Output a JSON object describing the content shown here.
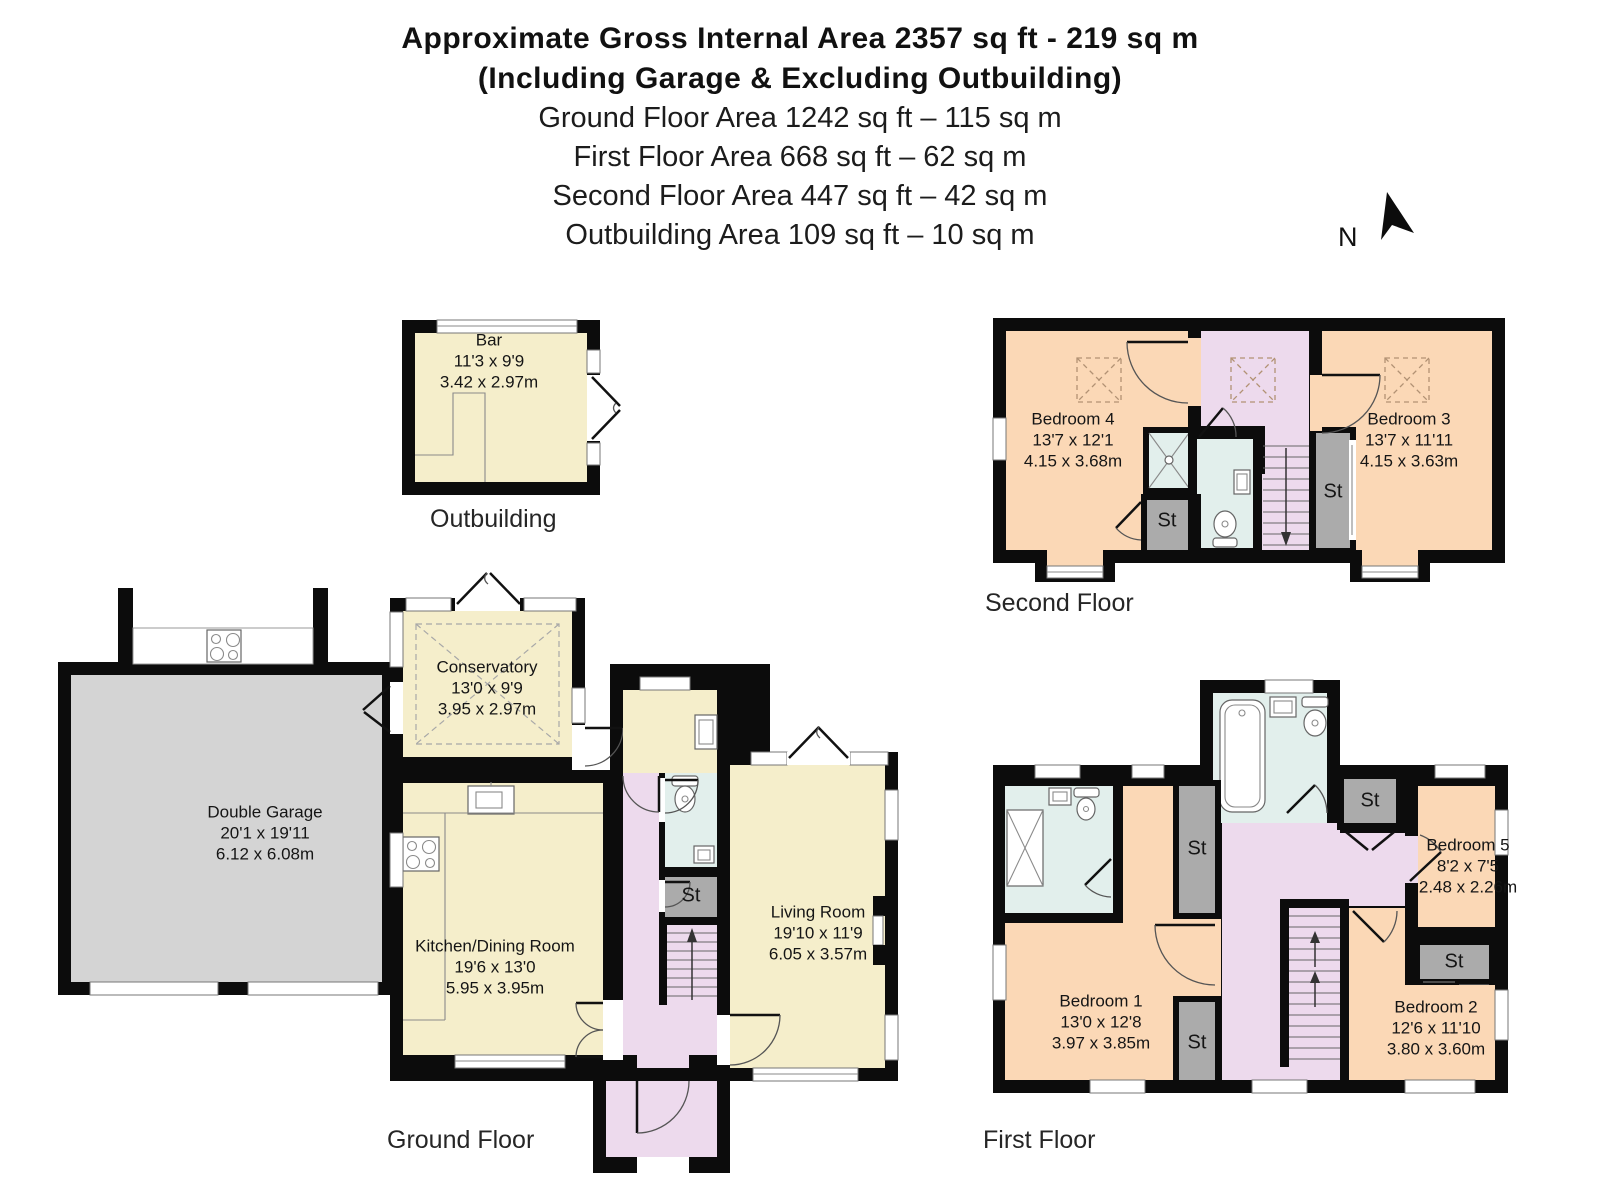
{
  "header": {
    "title_bold_1": "Approximate Gross Internal Area 2357 sq ft - 219 sq m",
    "title_bold_2": "(Including Garage & Excluding Outbuilding)",
    "area_lines": [
      "Ground Floor Area 1242 sq ft – 115 sq m",
      "First Floor Area 668 sq ft – 62 sq m",
      "Second Floor Area 447 sq ft – 42 sq m",
      "Outbuilding Area 109 sq ft – 10 sq m"
    ]
  },
  "compass": {
    "north_label": "N"
  },
  "labels": {
    "st": "St"
  },
  "floor_labels": {
    "outbuilding": "Outbuilding",
    "ground": "Ground Floor",
    "first": "First Floor",
    "second": "Second Floor"
  },
  "rooms": {
    "bar": {
      "name": "Bar",
      "imperial": "11'3 x 9'9",
      "metric": "3.42 x 2.97m"
    },
    "garage": {
      "name": "Double Garage",
      "imperial": "20'1 x 19'11",
      "metric": "6.12 x 6.08m"
    },
    "conservatory": {
      "name": "Conservatory",
      "imperial": "13'0 x 9'9",
      "metric": "3.95 x 2.97m"
    },
    "kitchen": {
      "name": "Kitchen/Dining Room",
      "imperial": "19'6 x 13'0",
      "metric": "5.95 x 3.95m"
    },
    "living": {
      "name": "Living Room",
      "imperial": "19'10 x 11'9",
      "metric": "6.05 x 3.57m"
    },
    "bedroom1": {
      "name": "Bedroom 1",
      "imperial": "13'0 x 12'8",
      "metric": "3.97 x 3.85m"
    },
    "bedroom2": {
      "name": "Bedroom 2",
      "imperial": "12'6 x 11'10",
      "metric": "3.80 x 3.60m"
    },
    "bedroom5": {
      "name": "Bedroom 5",
      "imperial": "8'2 x 7'5",
      "metric": "2.48 x 2.26m"
    },
    "bedroom3": {
      "name": "Bedroom 3",
      "imperial": "13'7 x 11'11",
      "metric": "4.15 x 3.63m"
    },
    "bedroom4": {
      "name": "Bedroom 4",
      "imperial": "13'7 x 12'1",
      "metric": "4.15 x 3.68m"
    }
  },
  "colors": {
    "wall": "#0c0c0c",
    "cream": "#f5eecb",
    "peach": "#fbd8b6",
    "lilac": "#eddaed",
    "bath_blue": "#e2efec",
    "storage_gray": "#ababab",
    "garage_gray": "#d4d4d4"
  }
}
